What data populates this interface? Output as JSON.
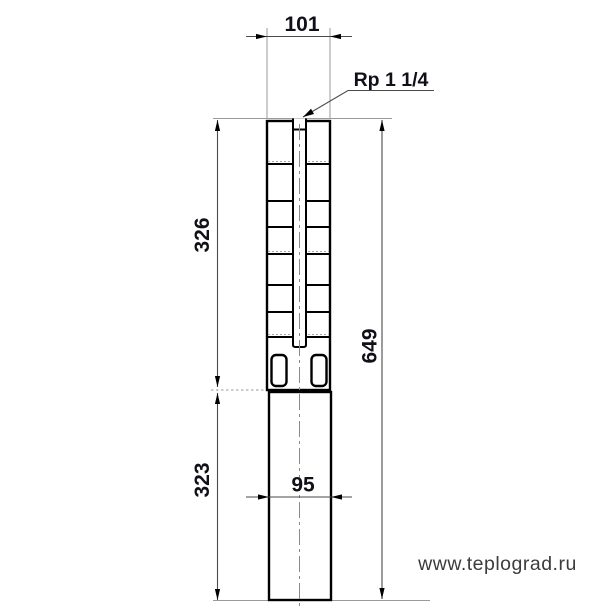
{
  "drawing": {
    "type": "technical-dimension-drawing",
    "subject": "submersible-pump-outline",
    "dimensions": {
      "top_width": "101",
      "connection_thread": "Rp 1 1/4",
      "pump_section_height": "326",
      "motor_section_height": "323",
      "total_height": "649",
      "motor_width": "95"
    },
    "watermark": "www.teplograd.ru",
    "colors": {
      "outline": "#000000",
      "dimension_text": "#101018",
      "dimension_line": "#4a4a4a",
      "extension_line": "#9a9a9a",
      "watermark_text": "#3c3c3c",
      "background": "#ffffff"
    }
  }
}
